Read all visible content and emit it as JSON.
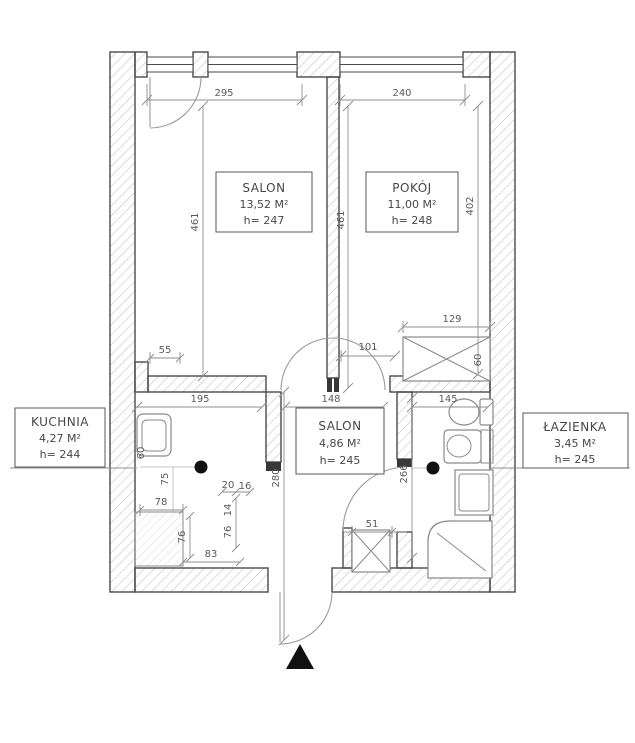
{
  "colors": {
    "background": "#ffffff",
    "wall_line": "#4a4a4a",
    "wall_hatch": "#c4c4c4",
    "dimension": "#8f8f8f",
    "text": "#474747",
    "marker": "#111111"
  },
  "rooms": [
    {
      "name": "SALON",
      "area": "13,52 M²",
      "height": "h= 247"
    },
    {
      "name": "POKÓJ",
      "area": "11,00 M²",
      "height": "h= 248"
    },
    {
      "name": "KUCHNIA",
      "area": "4,27 M²",
      "height": "h= 244"
    },
    {
      "name": "SALON",
      "area": "4,86 M²",
      "height": "h= 245"
    },
    {
      "name": "ŁAZIENKA",
      "area": "3,45 M²",
      "height": "h= 245"
    }
  ],
  "dimensions": {
    "top_left": "295",
    "top_right": "240",
    "salon_left": "461",
    "salon_right": "461",
    "pokoj_right": "402",
    "kitchen_nib": "55",
    "kitchen_width": "195",
    "hall_width": "148",
    "pokoj_opening": "101",
    "wardrobe_width": "129",
    "wardrobe_depth": "60",
    "bath_width": "145",
    "hall_depth": "280",
    "bath_depth": "266",
    "counter_width": "78",
    "counter_left": "76",
    "counter_bottom": "83",
    "door_side": "76",
    "door_top": "14",
    "door_nib_a": "20",
    "door_nib_b": "16",
    "dot_offset": "75",
    "sink_depth": "60",
    "shaft_width": "51"
  }
}
